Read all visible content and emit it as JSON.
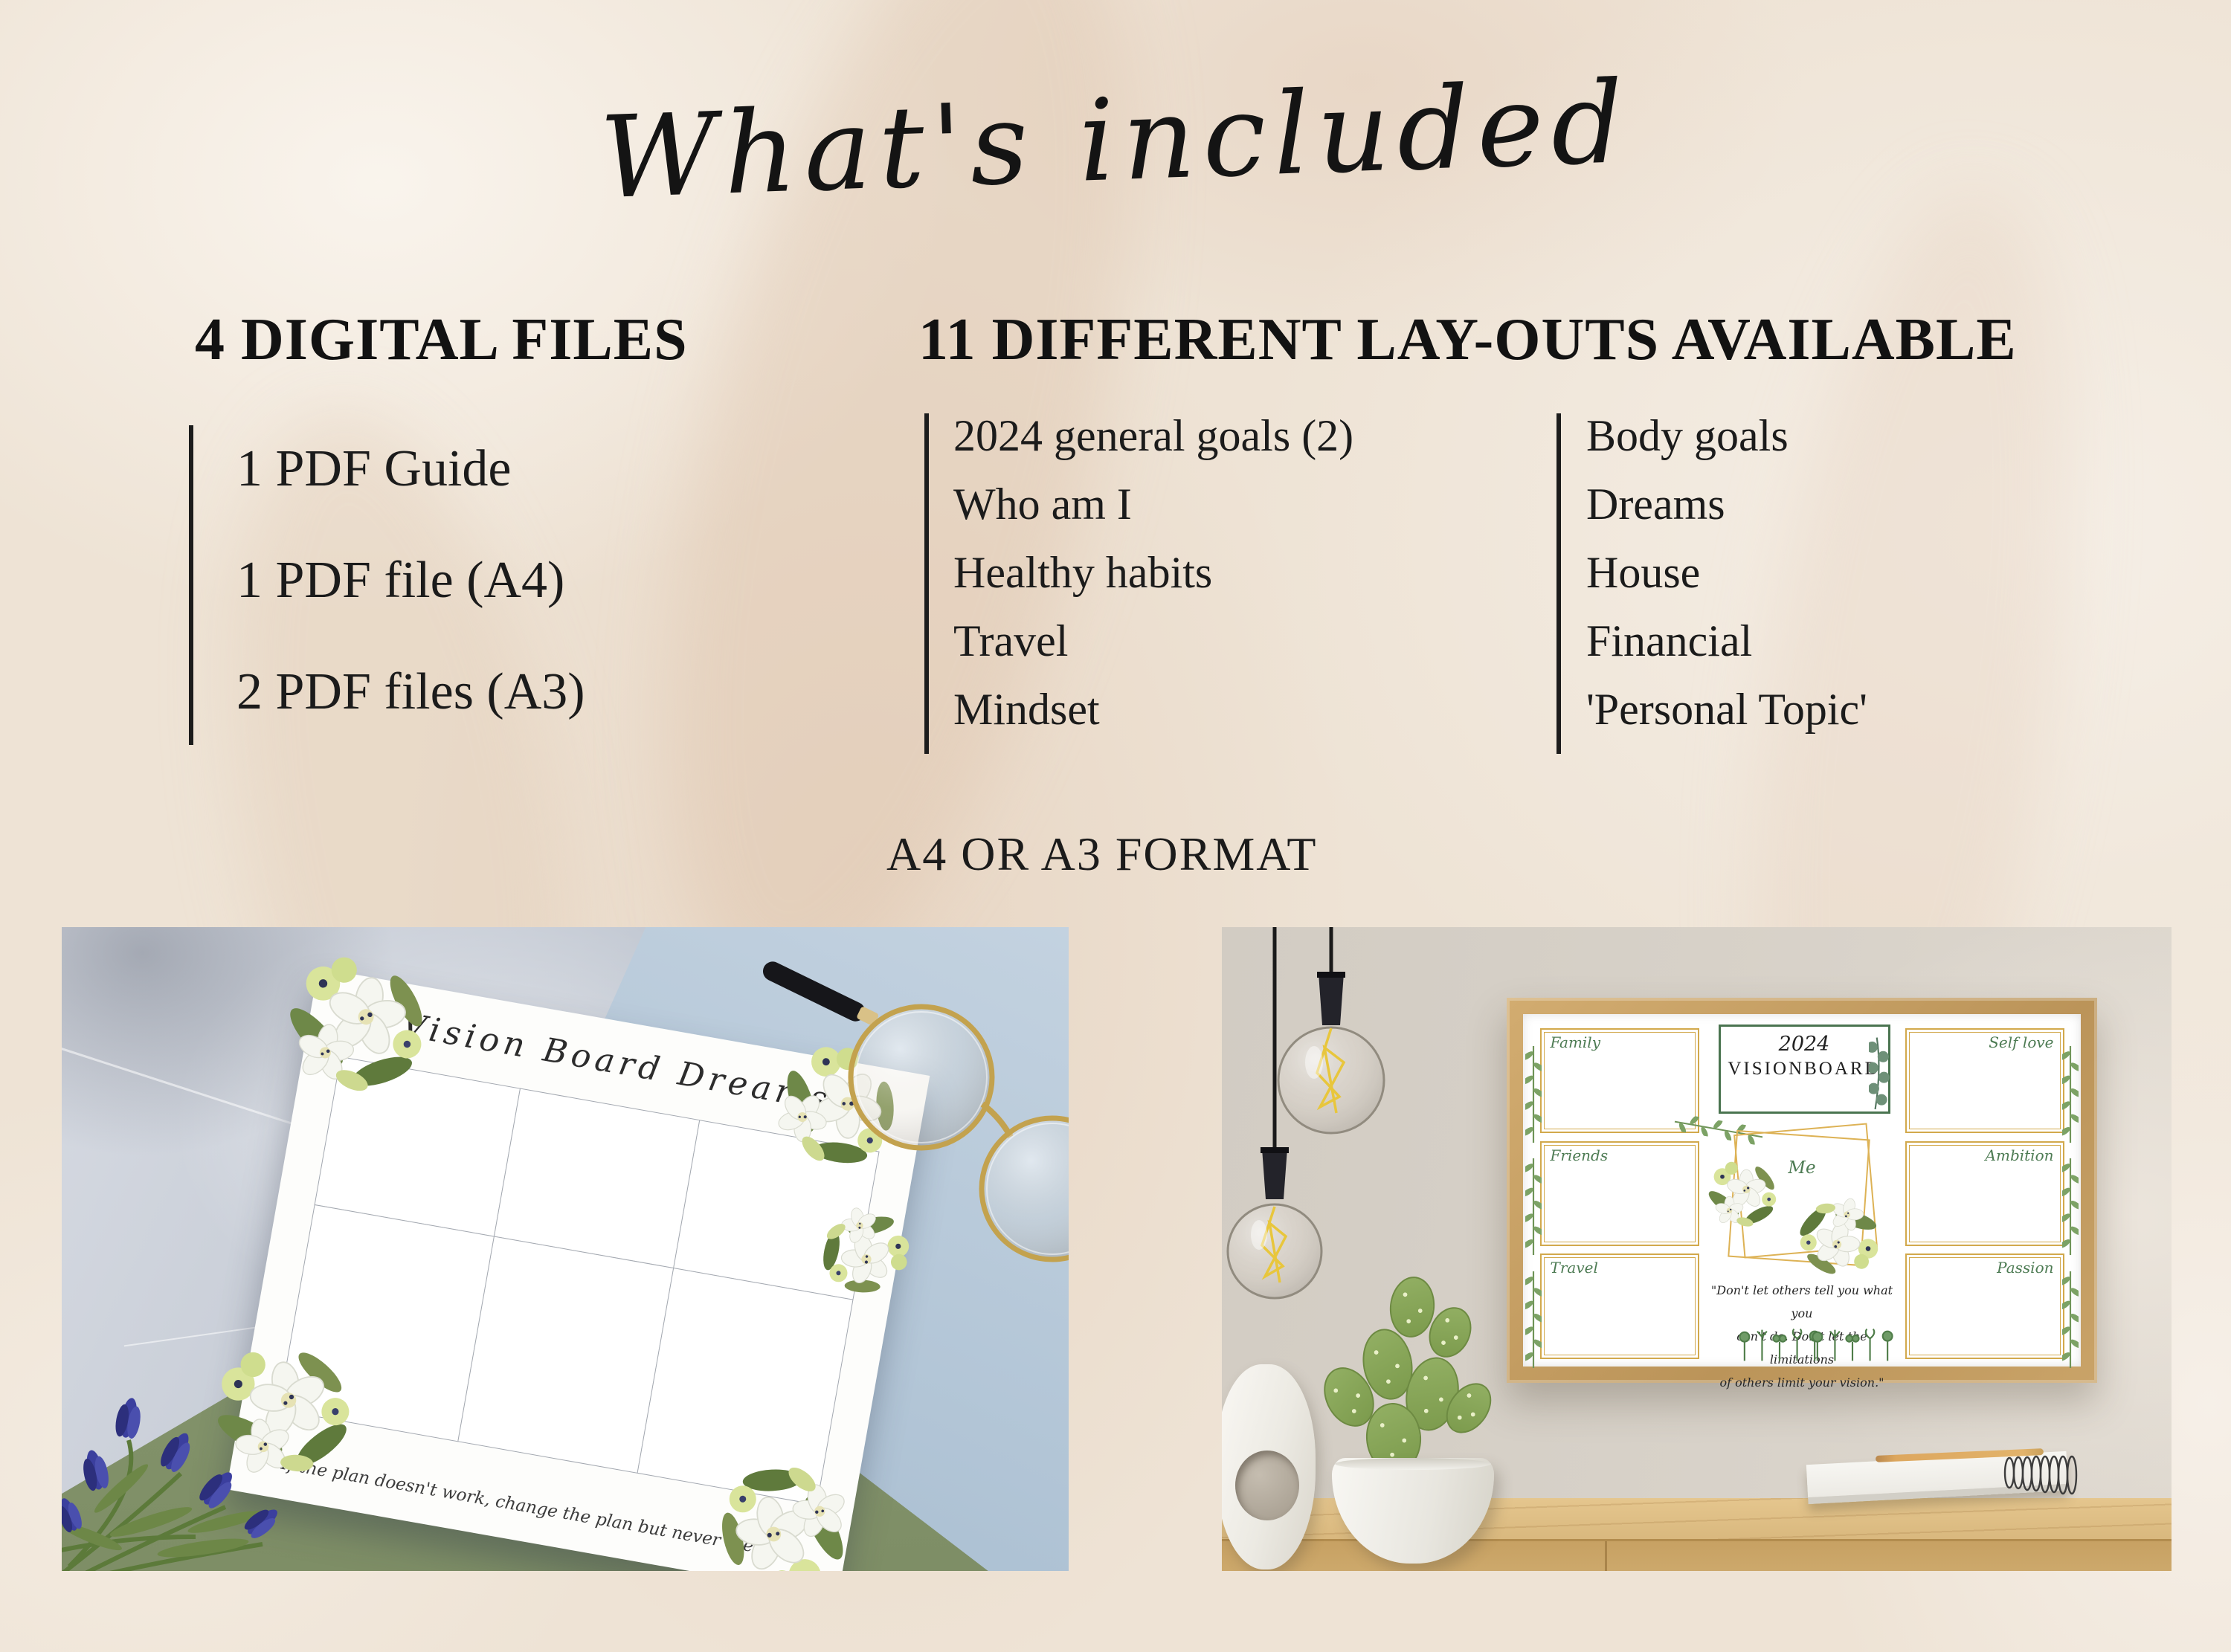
{
  "title": "What's included",
  "files_section": {
    "heading": "4 DIGITAL FILES",
    "items": [
      "1 PDF Guide",
      "1 PDF file (A4)",
      "2 PDF files (A3)"
    ]
  },
  "layouts_section": {
    "heading": "11 DIFFERENT LAY-OUTS AVAILABLE",
    "column1": [
      "2024 general goals (2)",
      "Who am I",
      "Healthy habits",
      "Travel",
      "Mindset"
    ],
    "column2": [
      "Body goals",
      "Dreams",
      "House",
      "Financial",
      "'Personal Topic'"
    ]
  },
  "format_note": "A4 OR A3 FORMAT",
  "left_photo": {
    "board_title": "Vision Board Dreams",
    "quote": "\"If the plan doesn't work, change the plan  but never the goal\""
  },
  "right_photo": {
    "year": "2024",
    "poster_title": "VISIONBOARD",
    "labels": {
      "family": "Family",
      "friends": "Friends",
      "travel": "Travel",
      "me": "Me",
      "self_love": "Self love",
      "ambition": "Ambition",
      "passion": "Passion"
    },
    "quote_lines": [
      "\"Don't let others tell you what you",
      "can't do. Don't let the limitations",
      "of others limit your vision.\""
    ]
  },
  "colors": {
    "background": "#eee3d5",
    "text": "#1b1b1b",
    "gold": "#d2a94c",
    "green_label": "#4d7b53",
    "wood_frame": "#c59f63",
    "marble": "#c9cfd9",
    "green_paper": "#86966e",
    "blue_paper": "#b4c7d8"
  }
}
